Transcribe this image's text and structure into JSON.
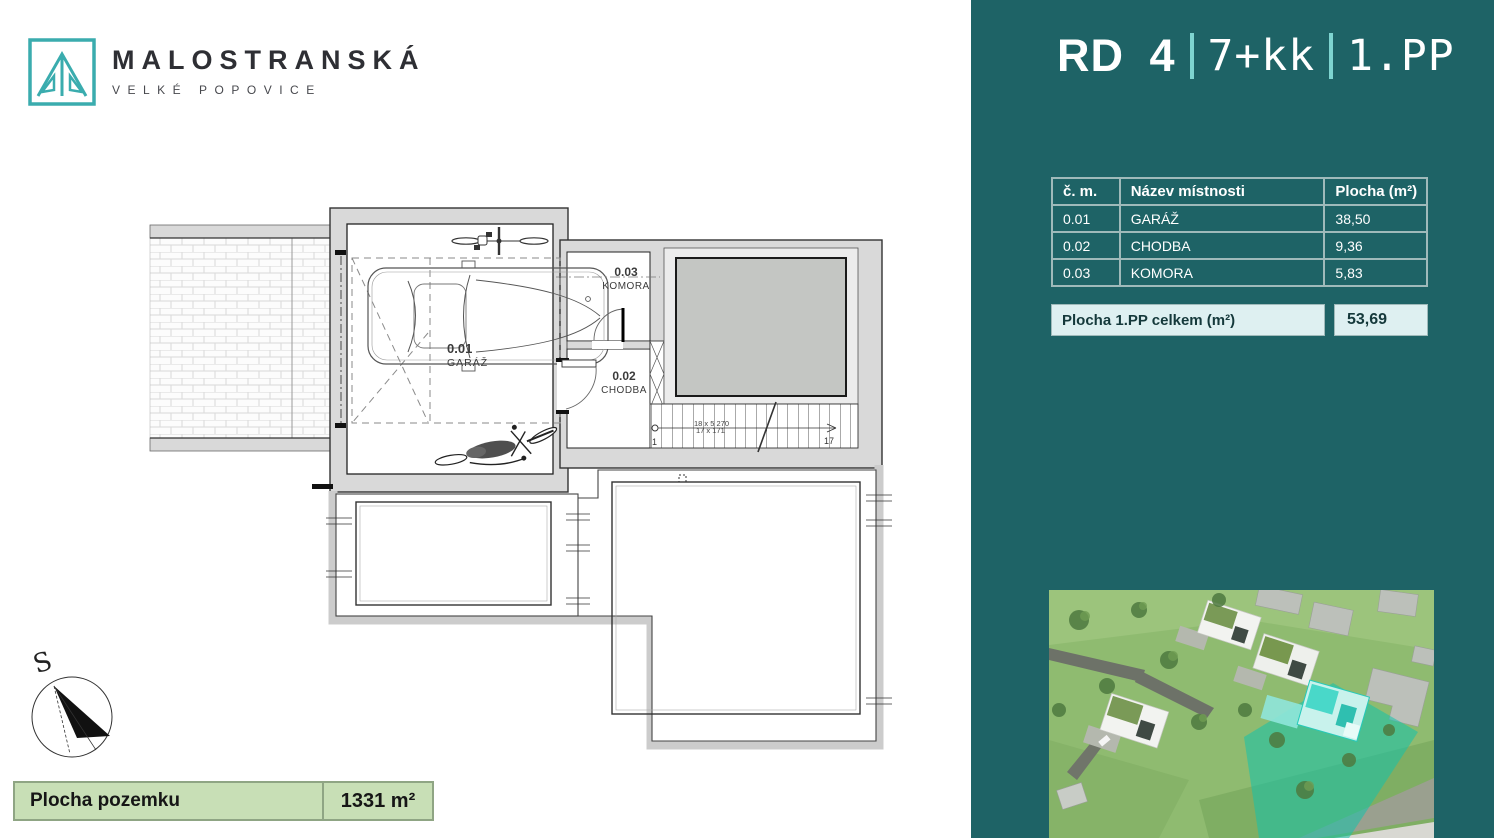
{
  "logo": {
    "title": "MALOSTRANSKÁ",
    "subtitle": "VELKÉ POPOVICE"
  },
  "header": {
    "unit": "RD 4",
    "layout": "7+kk",
    "floor": "1.PP"
  },
  "room_table": {
    "columns": [
      "č. m.",
      "Název místnosti",
      "Plocha (m²)"
    ],
    "rows": [
      [
        "0.01",
        "GARÁŽ",
        "38,50"
      ],
      [
        "0.02",
        "CHODBA",
        "9,36"
      ],
      [
        "0.03",
        "KOMORA",
        "5,83"
      ]
    ],
    "total_label": "Plocha 1.PP celkem (m²)",
    "total_value": "53,69"
  },
  "floor_plan": {
    "rooms": [
      {
        "number": "0.01",
        "name": "GARÁŽ"
      },
      {
        "number": "0.02",
        "name": "CHODBA"
      },
      {
        "number": "0.03",
        "name": "KOMORA"
      }
    ],
    "stairs": {
      "dim_line1": "18 x 5 270",
      "dim_line2": "17 x 171",
      "first_step": "1",
      "last_step": "17"
    },
    "compass_label": "S"
  },
  "plot_bar": {
    "label": "Plocha pozemku",
    "value": "1331 m²"
  },
  "colors": {
    "panel_teal": "#1e6366",
    "accent_light_teal": "#7ed4d0",
    "logo_teal": "#3aacae",
    "table_border": "#9fbaba",
    "total_row_bg": "#def0f1",
    "plot_bar_bg": "#c8dfb6",
    "plot_bar_border": "#8fa584",
    "plan_wall_gray": "#d9d9d9",
    "plan_solid_block": "#c4c6c3",
    "photo_highlight_teal": "#18c9b4"
  }
}
